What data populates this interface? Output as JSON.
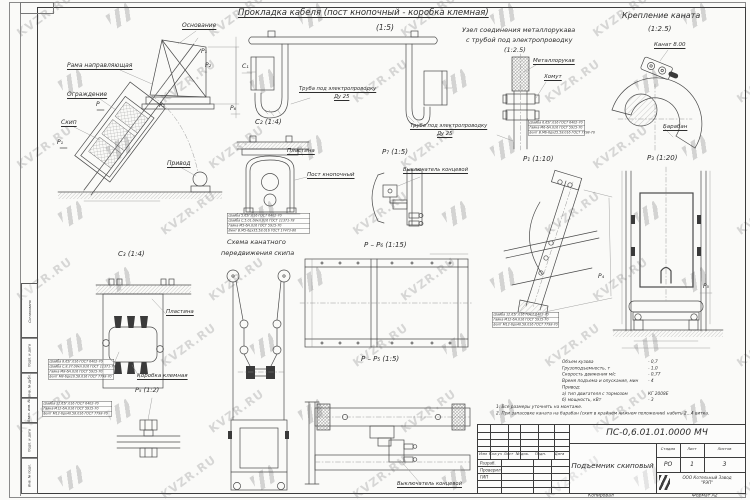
{
  "watermark": {
    "text": "KVZR.RU"
  },
  "corner": {
    "copied": "Копировал",
    "format": "Формат А2"
  },
  "titles": {
    "cable": "Прокладка кабеля (пост кнопочный - коробка клемная)",
    "cable_scale": "(1:5)",
    "hose1": "Узел соединения металлорукава",
    "hose2": "с трубой под электропроводку",
    "hose_scale": "(1:2.5)",
    "rope": "Крепление каната",
    "rope_scale": "(1:2.5)",
    "scheme1": "Схема канатного",
    "scheme2": "передвижения скипа"
  },
  "labels": {
    "osnovanie": "Основание",
    "rama": "Рама направляющая",
    "ograzhdenie": "Ограждение",
    "skip": "Скип",
    "privod": "Привод",
    "truba": "Труба под электропроводку",
    "du25": "Ду 25",
    "plastina": "Пластина",
    "post": "Пост кнопочный",
    "vykl": "Выключатель концевой",
    "metallorukav": "Металлорукав",
    "khomut": "Хомут",
    "kanat": "Канат 8.00",
    "baraban": "Барабан",
    "korobka": "Коробка клемная"
  },
  "marks": {
    "p1": "Р₁",
    "p2": "Р₂",
    "p": "Р",
    "p4": "Р₄",
    "p5": "Р₅",
    "p6": "Р₆",
    "c1": "С₁",
    "c2v": "С₂ (1:4)",
    "c3v": "С₃ (1:4)",
    "p5v": "Р₅ (1:2)",
    "p7v": "Р₇ (1:5)",
    "p1v": "Р₁ (1:10)",
    "p3v": "Р₃ (1:20)",
    "pp6": "Р – Р₆ (1:15)",
    "pp5": "Р – Р₅ (1:5)"
  },
  "parts": {
    "hose": [
      "Шайба 6.65Г.016 ГОСТ 6402-70",
      "Гайка М6-6Н.016 ГОСТ 5915-70",
      "Болт В.М6-6gх25.58.016 ГОСТ 7798-70"
    ],
    "post": [
      "Шайба 5.65Г.016 ГОСТ 6402-70",
      "Шайба С.5.01.08кп.016 ГОСТ 11371-78",
      "Гайка М5-6Н.016 ГОСТ 5915-70",
      "Винт В.М5-6gх35.58.016 ГОСТ 17473-80"
    ],
    "box": [
      "Шайба 8.65Г.016 ГОСТ 6402-70",
      "Шайба С.8.37.08кп.016 ГОСТ 11371-78",
      "Гайка М8-6Н.016 ГОСТ 5915-70",
      "Болт М8-6gх10.58.016 ГОСТ 7798-70"
    ],
    "p5": [
      "Шайба 12.65Г.016 ГОСТ 6402-70",
      "Гайка М12-6Н.016 ГОСТ 5915-70",
      "Болт М12-6gх40.58.016 ГОСТ 7798-70"
    ],
    "p1": [
      "Шайба 12.65Г.016 ГОСТ 6402-70",
      "Гайка М12-6Н.016 ГОСТ 5915-70",
      "Болт М12-6gх40.58.016 ГОСТ 7798-70"
    ]
  },
  "specs": {
    "rows": [
      {
        "k": "Объем кузова",
        "v": "- 0,7"
      },
      {
        "k": "Грузоподъемность, т",
        "v": "- 1,0"
      },
      {
        "k": "Скорость движения м/с",
        "v": "- 0,77"
      },
      {
        "k": "Время подъема и опускания, мин",
        "v": "- 4"
      },
      {
        "k": "Привод:",
        "v": ""
      },
      {
        "k": "а) тип двигателя с тормозом",
        "v": "КГ 2008Е"
      },
      {
        "k": "б) мощность, кВт",
        "v": "- 3"
      }
    ]
  },
  "notes": [
    "1. Все размеры уточнять на монтаже.",
    "2. При запасовке каната на барабан (скип в крайнем нижнем положении) набить 2...4 витка."
  ],
  "stamp": {
    "doc_number": "ПС-0,6.01.01.0000 МЧ",
    "title": "Подъемник скиповый",
    "stage_label": "Стадия",
    "sheet_label": "Лист",
    "sheets_label": "Листов",
    "stage": "РО",
    "sheet": "1",
    "sheets": "3",
    "company1": "ООО Котельный Завод",
    "company2": "\"РЭП\"",
    "header": [
      "Изм",
      "Кол.уч",
      "Лист",
      "№ док.",
      "Подп.",
      "Дата"
    ],
    "rows": [
      "Разраб.",
      "Проверил",
      "ГИП"
    ]
  },
  "side_strip": [
    "Согласовано",
    "Подп. и дата",
    "Инв. № дубл.",
    "Взам. инв. №",
    "Подп. и дата",
    "Инв. № подл."
  ]
}
